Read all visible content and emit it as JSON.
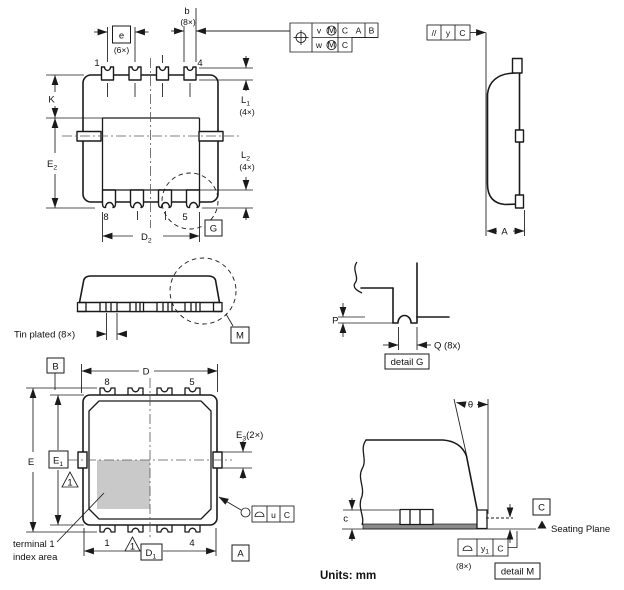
{
  "footer": {
    "units": "Units: mm"
  },
  "top_view": {
    "b": "b",
    "b_note": "(8×)",
    "e": "e",
    "e_note": "(6×)",
    "pin1": "1",
    "pin4": "4",
    "pin8": "8",
    "pin5": "5",
    "k": "K",
    "e2": "E",
    "e2_sub": "2",
    "l1": "L",
    "l1_sub": "1",
    "l1_note": "(4×)",
    "l2": "L",
    "l2_sub": "2",
    "l2_note": "(4×)",
    "d2": "D",
    "d2_sub": "2",
    "g": "G"
  },
  "pos_frame": {
    "v": "v",
    "v_mod": "M",
    "v_datum1": "C",
    "v_datum2": "A",
    "v_datum3": "B",
    "w": "w",
    "w_mod": "M",
    "w_datum1": "C"
  },
  "par_frame": {
    "symbol": "//",
    "dim": "y",
    "datum": "C"
  },
  "side_view": {
    "a": "A"
  },
  "front_view": {
    "tin_plated": "Tin plated (8×)",
    "m": "M"
  },
  "detail_g": {
    "p": "P",
    "q": "Q (8x)",
    "caption": "detail G"
  },
  "bottom_view": {
    "datum_b": "B",
    "datum_a": "A",
    "d": "D",
    "d1": "D",
    "d1_sub": "1",
    "e": "E",
    "e1": "E",
    "e1_sub": "1",
    "e3": "E",
    "e3_sub": "3",
    "e3_note": "(2×)",
    "pin8": "8",
    "pin5": "5",
    "pin1": "1",
    "pin4": "4",
    "note1": "1",
    "note2": "1",
    "index1": "terminal 1",
    "index2": "index area"
  },
  "u_frame": {
    "dim": "u",
    "datum": "C"
  },
  "detail_m": {
    "c": "c",
    "theta": "θ",
    "datum": "C",
    "seating": "Seating Plane",
    "y1": "y",
    "y1_sub": "1",
    "y1_datum": "C",
    "y1_note": "(8×)",
    "caption": "detail M"
  }
}
